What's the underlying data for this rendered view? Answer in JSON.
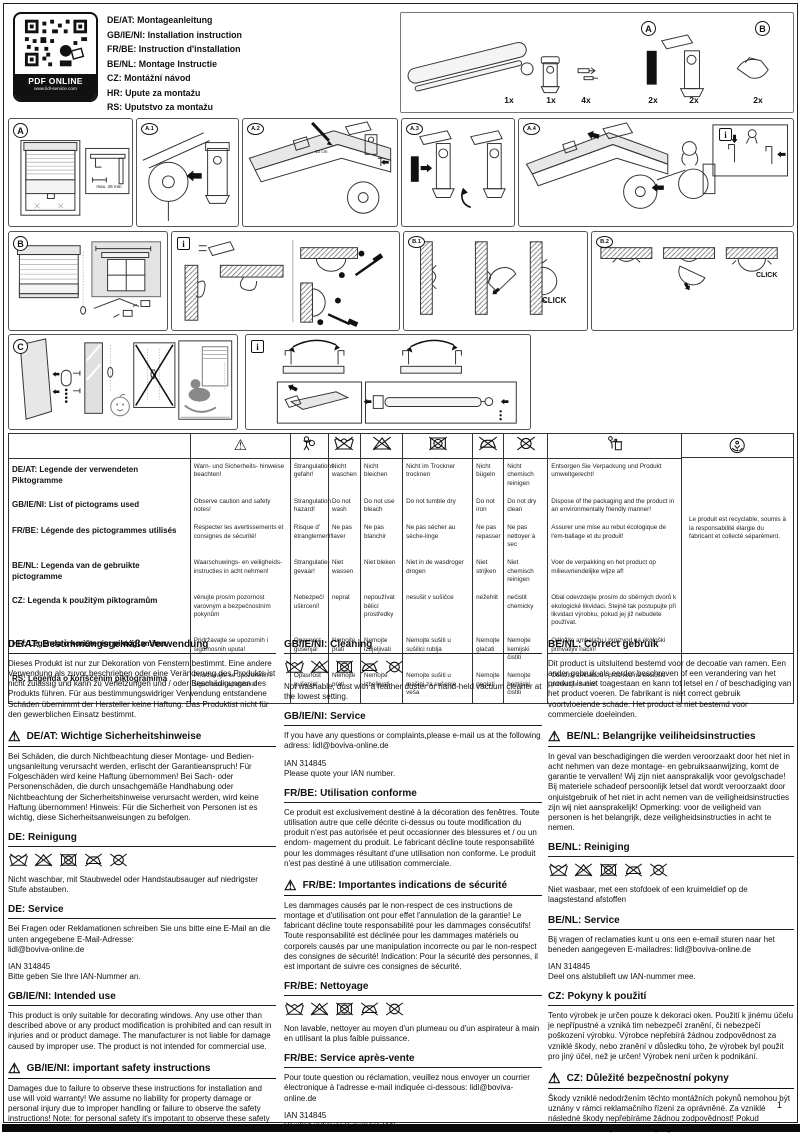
{
  "page": {
    "number": "1"
  },
  "icons": {
    "warning": "⚠",
    "info": "i"
  },
  "header": {
    "qr": {
      "label": "PDF ONLINE",
      "url": "www.lidl-service.com"
    },
    "languages": [
      "DE/AT: Montageanleitung",
      "GB/IE/NI: Installation instruction",
      "FR/BE: Instruction d'installation",
      "BE/NL: Montage Instructie",
      "CZ: Montážní návod",
      "HR: Upute za montažu",
      "RS: Uputstvo za montažu"
    ],
    "parts": {
      "group_a_label": "A",
      "group_b_label": "B",
      "quantities": [
        "1x",
        "1x",
        "4x",
        "2x",
        "2x",
        "2x"
      ]
    }
  },
  "panels": {
    "labels": {
      "a": "A",
      "a1": "A.1",
      "a2": "A.2",
      "a3": "A.3",
      "a4": "A.4",
      "b": "B",
      "b1": "B.1",
      "b2": "B.2",
      "c": "C"
    },
    "annotations": {
      "max_width": "max. 25 mm",
      "mark_distance": "10 cm",
      "click": "CLICK"
    }
  },
  "pictogram_table": {
    "recycle_note": "Le produit est recyclable, soumis à la responsabilité élargie du fabricant et collecté séparément.",
    "rows": [
      {
        "legend": "DE/AT: Legende der verwendeten Piktogramme",
        "warn": "Warn- und Sicherheits-\nhinweise beachten!",
        "strangulation": "Strangulations gefahr!",
        "wash": "Nicht waschen",
        "bleach": "Nicht bleichen",
        "tumble_dry": "Nicht im Trockner trocknen",
        "iron": "Nicht bügeln",
        "dry_clean": "Nicht chemisch reinigen",
        "disposal": "Entsorgen Sie Verpackung und Produkt umweltgerecht!"
      },
      {
        "legend": "GB/IE/NI: List of pictograms used",
        "warn": "Observe caution\nand safety notes!",
        "strangulation": "Strangulation hazard!",
        "wash": "Do not wash",
        "bleach": "Do not use bleach",
        "tumble_dry": "Do not tumble dry",
        "iron": "Do not iron",
        "dry_clean": "Do not dry clean",
        "disposal": "Dispose of the packaging and the product in an environmentally friendly manner!"
      },
      {
        "legend": "FR/BE: Légende des pictogrammes utilisés",
        "warn": "Respecter les avertissements\net consignes de sécurité!",
        "strangulation": "Risque d' étranglement!",
        "wash": "Ne pas laver",
        "bleach": "Ne pas blanchir",
        "tumble_dry": "Ne pas sécher au sèche-linge",
        "iron": "Ne pas repasser",
        "dry_clean": "Ne pas nettoyer à sec",
        "disposal": "Assurer une mise au rebut écologique de l'em-ballage et du produit!"
      },
      {
        "legend": "BE/NL: Legenda van de gebruikte pictogramme",
        "warn": "Waarschuwings- en veiligheids-\ninstructies in acht nehmen!",
        "strangulation": "Strangulatie- gevaar!",
        "wash": "Niet wassen",
        "bleach": "Niet bleken",
        "tumble_dry": "Niet in de wasdroger drogen",
        "iron": "Niet strijken",
        "dry_clean": "Niet chemisch reinigen",
        "disposal": "Voer de verpakking en het product op milieuvriendelijke wijze af!"
      },
      {
        "legend": "CZ: Legenda k použitým piktogramům",
        "warn": "věnujte prosím pozornost varovným\na bezpečnostním pokynům",
        "strangulation": "Nebezpečí uškrcení!",
        "wash": "neprat",
        "bleach": "nepoužívat bělicí prostředky",
        "tumble_dry": "nesušit v sušičce",
        "iron": "nežehlit",
        "dry_clean": "nečistit chemicky",
        "disposal": "Obal odevzdejte prosím do sběrných dvorů k ekologické likvidaci. Stejně tak postupujte při likvidaci výrobku, pokud jej již nebudete používat."
      },
      {
        "legend": "HR: Legenda o korištenim piktogramima",
        "warn": "Pridržavajte se upozornih\ni sigurnosnih uputa!",
        "strangulation": "Opasnost gušenja!",
        "wash": "Nemojte prati",
        "bleach": "Nemojte izbjeljivati",
        "tumble_dry": "Nemojte sušiti u sušilici rublja",
        "iron": "Nemojte glačati",
        "dry_clean": "Nemojte kemijski čistiti",
        "disposal": "Odložite ambalažu i proizvod na ekološki prihvatljiv način!"
      },
      {
        "legend": "RS: Legenda o korišćenim piktogramima",
        "warn": "Pridržavajte se upozorenih\ni sigurnosnih uputstava!",
        "strangulation": "Opasnost gušenja!",
        "wash": "Nemojte prati",
        "bleach": "Nemojte izbeljivati",
        "tumble_dry": "Nemojte sušiti u mašini za sušenje veša",
        "iron": "Nemojte peglati",
        "dry_clean": "Nemojte hemijski čistiti",
        "disposal": "Odložite ambalažu i proizvod na ekološki prihvatljiv način!"
      }
    ]
  },
  "sections": {
    "columns": [
      {
        "blocks": [
          {
            "t": "h",
            "x": "DE/AT: Bestimmungsgemäße Verwendung"
          },
          {
            "t": "p",
            "x": "Dieses Produkt ist nur zur Dekoration von Fenstern bestimmt. Eine andere Verwendung als zuvor beschrieben oder eine Veränderung des Produkts ist nicht zulässig und kann zu Verletzungen und / oder Beschädigungen des Produkts führen. Für aus bestimmungswidriger Verwendung entstandene Schäden übernimmt der Hersteller keine Haftung. Das Produktist nicht für den gewerblichen Einsatz bestimmt."
          },
          {
            "t": "wh",
            "x": "DE/AT: Wichtige Sicherheitshinweise"
          },
          {
            "t": "p",
            "x": "Bei Schäden, die durch Nichtbeachtung dieser Montage- und Bedien- ungsanleitung verursacht werden, erlischt der Garantieanspruch! Für Folgeschäden wird keine Haftung übernommen! Bei Sach- oder Personenschäden, die durch unsachgemäße Handhabung oder Nichtbeachtung der Sicherheitshinweise verursacht werden, wird keine Haftung übernommen! Hinweis: Für die Sicherheit von Personen ist es wichtig, diese Sicherheitsanweisungen zu befolgen."
          },
          {
            "t": "h",
            "x": "DE: Reinigung"
          },
          {
            "t": "care"
          },
          {
            "t": "p",
            "x": "Nicht waschbar, mit Staubwedel oder Handstaubsauger auf niedrigster Stufe abstauben."
          },
          {
            "t": "h",
            "x": "DE: Service"
          },
          {
            "t": "p",
            "x": "Bei Fragen oder Reklamationen schreiben  Sie uns bitte eine E-Mail an die unten angegebene E-Mail-Adresse:\nlidl@boviva-online.de"
          },
          {
            "t": "p",
            "x": "IAN 314845\nBitte geben Sie Ihre IAN-Nummer an."
          },
          {
            "t": "h",
            "x": "GB/IE/NI: Intended use"
          },
          {
            "t": "p",
            "x": "This product is only suitable for decorating windows. Any use other than described above or any product modification is prohibited and can result in injuries and or product damage. The manufacturer is not liable for damage caused by improper use. The product is not intended for commercial use."
          },
          {
            "t": "wh",
            "x": "GB/IE/NI:  important safety instructions"
          },
          {
            "t": "p",
            "x": "Damages due to failure to observe these instructions for installation and use will void warranty! We assume no liability for property damage or personal injury due to improper handling or failure to observe the safety instructions! Note: for personal safety it's impotant to observe these safety instructions."
          }
        ]
      },
      {
        "blocks": [
          {
            "t": "h",
            "x": "GB/IE/NI:  Cleaning"
          },
          {
            "t": "care"
          },
          {
            "t": "p",
            "x": "Not washable, dust with a feather duster or hand-held vacuum cleaner at the lowest setting."
          },
          {
            "t": "h",
            "x": "GB/IE/NI:  Service"
          },
          {
            "t": "p",
            "x": "If you have any questions or complaints,please e-mail us at the following adress: lidl@boviva-online.de"
          },
          {
            "t": "p",
            "x": "IAN 314845\nPlease quote your IAN number."
          },
          {
            "t": "h",
            "x": "FR/BE: Utilisation conforme"
          },
          {
            "t": "p",
            "x": "Ce produit est exclusivement destiné à la décoration des fenêtres. Toute utilisation autre que celle décrite ci-dessus ou toute modification du produit n'est pas autorisée et peut occasionner des blessures et / ou un endom- magement du produit. Le fabricant décline toute responsabilité pour les dommages résultant d'une utilisation non conforme. Le produit n'est pas destiné à une utilisation commerciale."
          },
          {
            "t": "wh",
            "x": "FR/BE: Importantes indications de sécurité"
          },
          {
            "t": "p",
            "x": "Les dammages causés par le non-respect de ces instructions de montage et d'utilisation ont pour effet l'annulation de la garantie! Le fabricant décline toute responsabilité pour les dammages consécutifs! Toute responsabilité est déclinée pour les dammages matériels ou corporels causés par une manipulation incorrecte ou par le non-respect des consignes de sécurité! Indication: Pour la sécurité des personnes, il est important de suivre ces consignes de sécurité."
          },
          {
            "t": "h",
            "x": "FR/BE: Nettoyage"
          },
          {
            "t": "care"
          },
          {
            "t": "p",
            "x": "Non lavable, nettoyer au moyen d'un plumeau ou d'un aspirateur à main en utilisant la plus faible puissance."
          },
          {
            "t": "h",
            "x": "FR/BE: Service après-vente"
          },
          {
            "t": "p",
            "x": "Pour toute question ou réclamation, veuillez nous envoyer un courrier électronique à l'adresse e-mail indiquée ci-dessous: lidl@boviva-online.de"
          },
          {
            "t": "p",
            "x": "IAN 314845\nVeuillez indiquer le numéro IAN."
          }
        ]
      },
      {
        "blocks": [
          {
            "t": "h",
            "x": "BE/NL: Correct gebruik"
          },
          {
            "t": "p",
            "x": "Dit product is uitsluitend bestemd voor de decoatie van ramen. Een ander gebruik als eerder beschreven of een verandering van het product is niet toagestaan en kann tot letsel en / of beschadiging van het product voeren. De fabrikant is niet correct gebruik voortvloeiende schade. Het product is niet bestemd voor commerciele doeleinden."
          },
          {
            "t": "wh",
            "x": "BE/NL: Belangrijke veiliheidsinstructies"
          },
          {
            "t": "p",
            "x": "In geval van beschadigingen die werden veroorzaakt door het niet in acht nehmen van deze montage- en gebruiksaanwijzing, komt de garantie te vervallen! Wij zijn niet aansprakalijk voor gevolgschade! Bij materiele schadeof persoonlijk letsel dat wordt veroorzaakt door onjuistgebruik of het niet in acht nemen van de veiligheidsinstructies zijn wij niet aansprakelijk! Opmerking: voor de veiligheid van personen is het belangrijk, deze veiligheidsinstructies in acht te nemen."
          },
          {
            "t": "h",
            "x": "BE/NL: Reiniging"
          },
          {
            "t": "care"
          },
          {
            "t": "p",
            "x": "Niet wasbaar, met een stofdoek of een kruimeldief op de laagstestand afstoffen"
          },
          {
            "t": "h",
            "x": "BE/NL: Service"
          },
          {
            "t": "p",
            "x": "Bij vragen of reclamaties kunt u ons een e-email sturen naar het beneden aangegeven E-mailadres: lidl@boviva-online.de"
          },
          {
            "t": "p",
            "x": "IAN 314845\nDeel ons alstublieft uw IAN-nummer mee."
          },
          {
            "t": "h",
            "x": "CZ: Pokyny k použití"
          },
          {
            "t": "p",
            "x": "Tento výrobek je určen pouze k dekoraci oken. Použití k jinému účelu je nepřípustné a vzniká tim nebezpečí zranění, či nebezpečí poškození výrobku. Výrobce nepřebírá žádnou zodpovědnost za vzniklé škody, nebo zranění v důsledku toho,  že výrobek byl použit pro jiný účel, než je určen! Výrobek není určen k podnikání."
          },
          {
            "t": "wh",
            "x": "CZ: Důležité bezpečnostní pokyny"
          },
          {
            "t": "p",
            "x": "Škody vzniklé nedodržením těchto montážních pokynů nemohou být uznány v rámci reklamačního řízení za oprávněné. Za vzniklé následné škody nepřebíráme žádnou zodpovědnost! Pokud nedodržením bezpečnostních pokynů a nedodržením návodu k montáži dojde k poškození věcí, nebo k poškození zdraví, tak za takto vzniklé škody neneseme žádnou zodpovědnost! POZOR: z důvodu bezpečnosti osob je důležité tyto bezpečnostní pokyny respektovat"
          }
        ]
      }
    ]
  }
}
